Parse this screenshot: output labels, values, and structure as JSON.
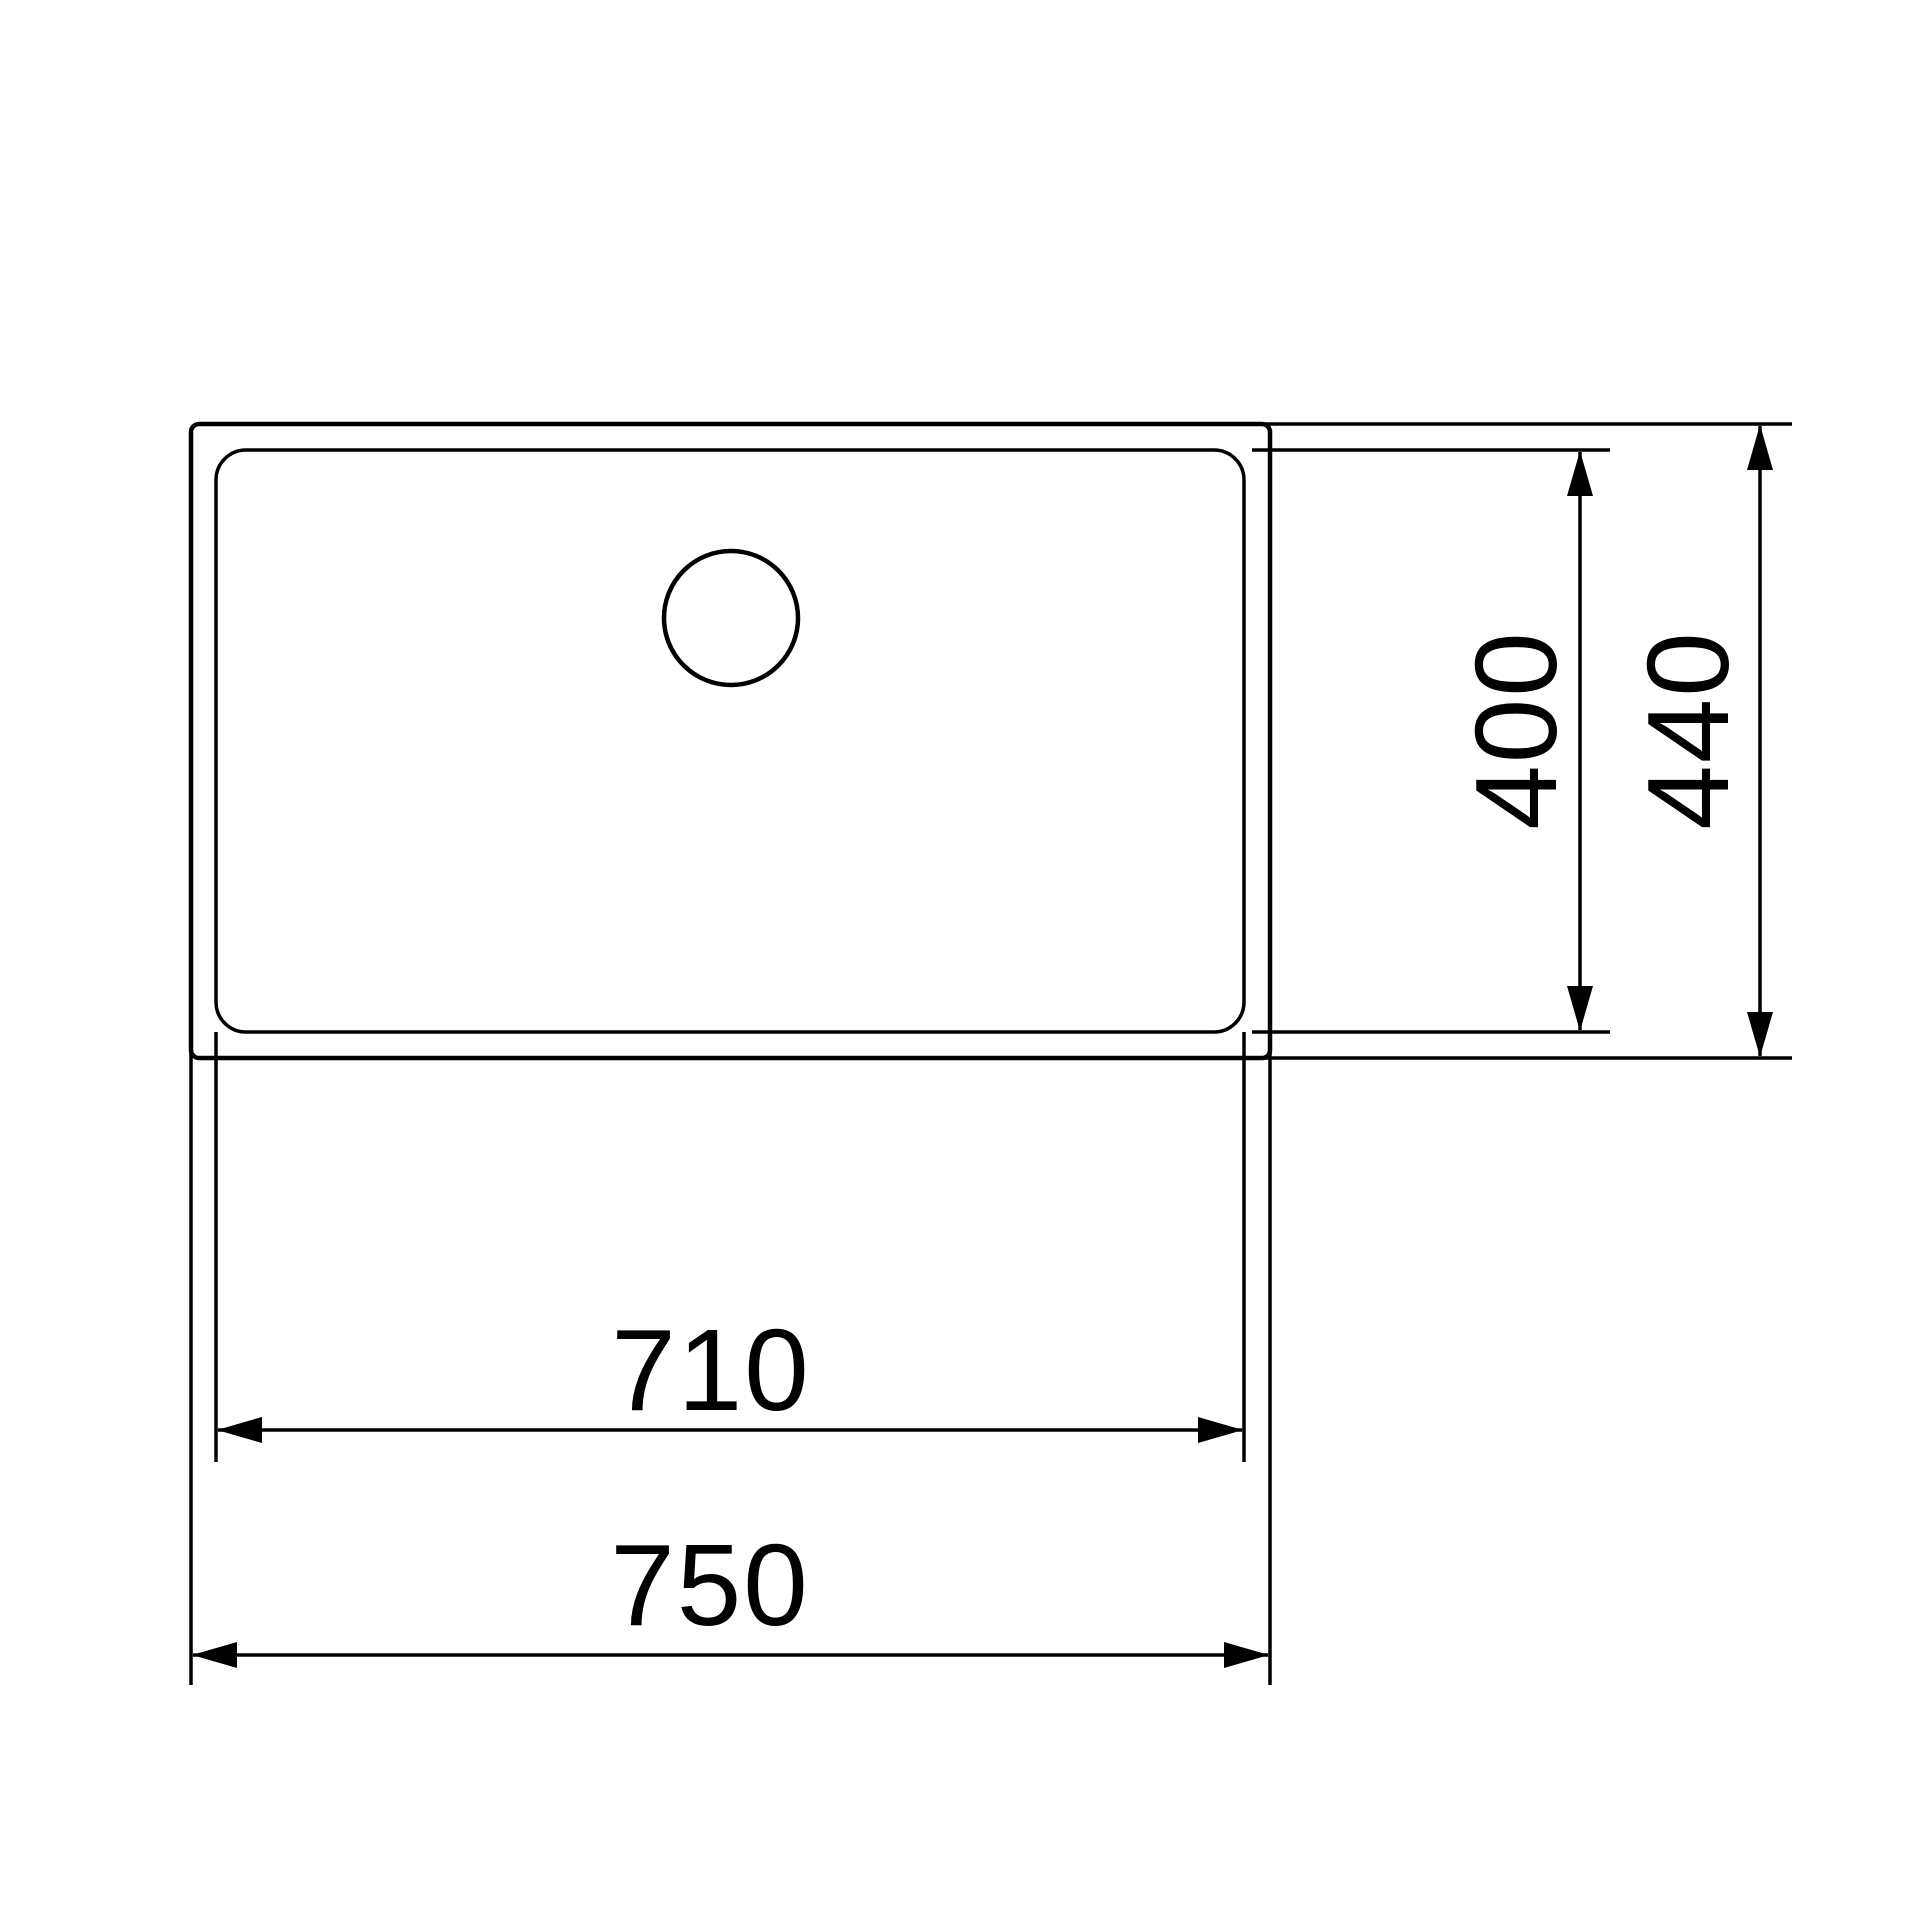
{
  "page": {
    "background_color": "#ffffff",
    "line_color": "#000000"
  },
  "dimensions": {
    "inner_width": {
      "label": "710"
    },
    "outer_width": {
      "label": "750"
    },
    "inner_depth": {
      "label": "400"
    },
    "outer_depth": {
      "label": "440"
    }
  }
}
